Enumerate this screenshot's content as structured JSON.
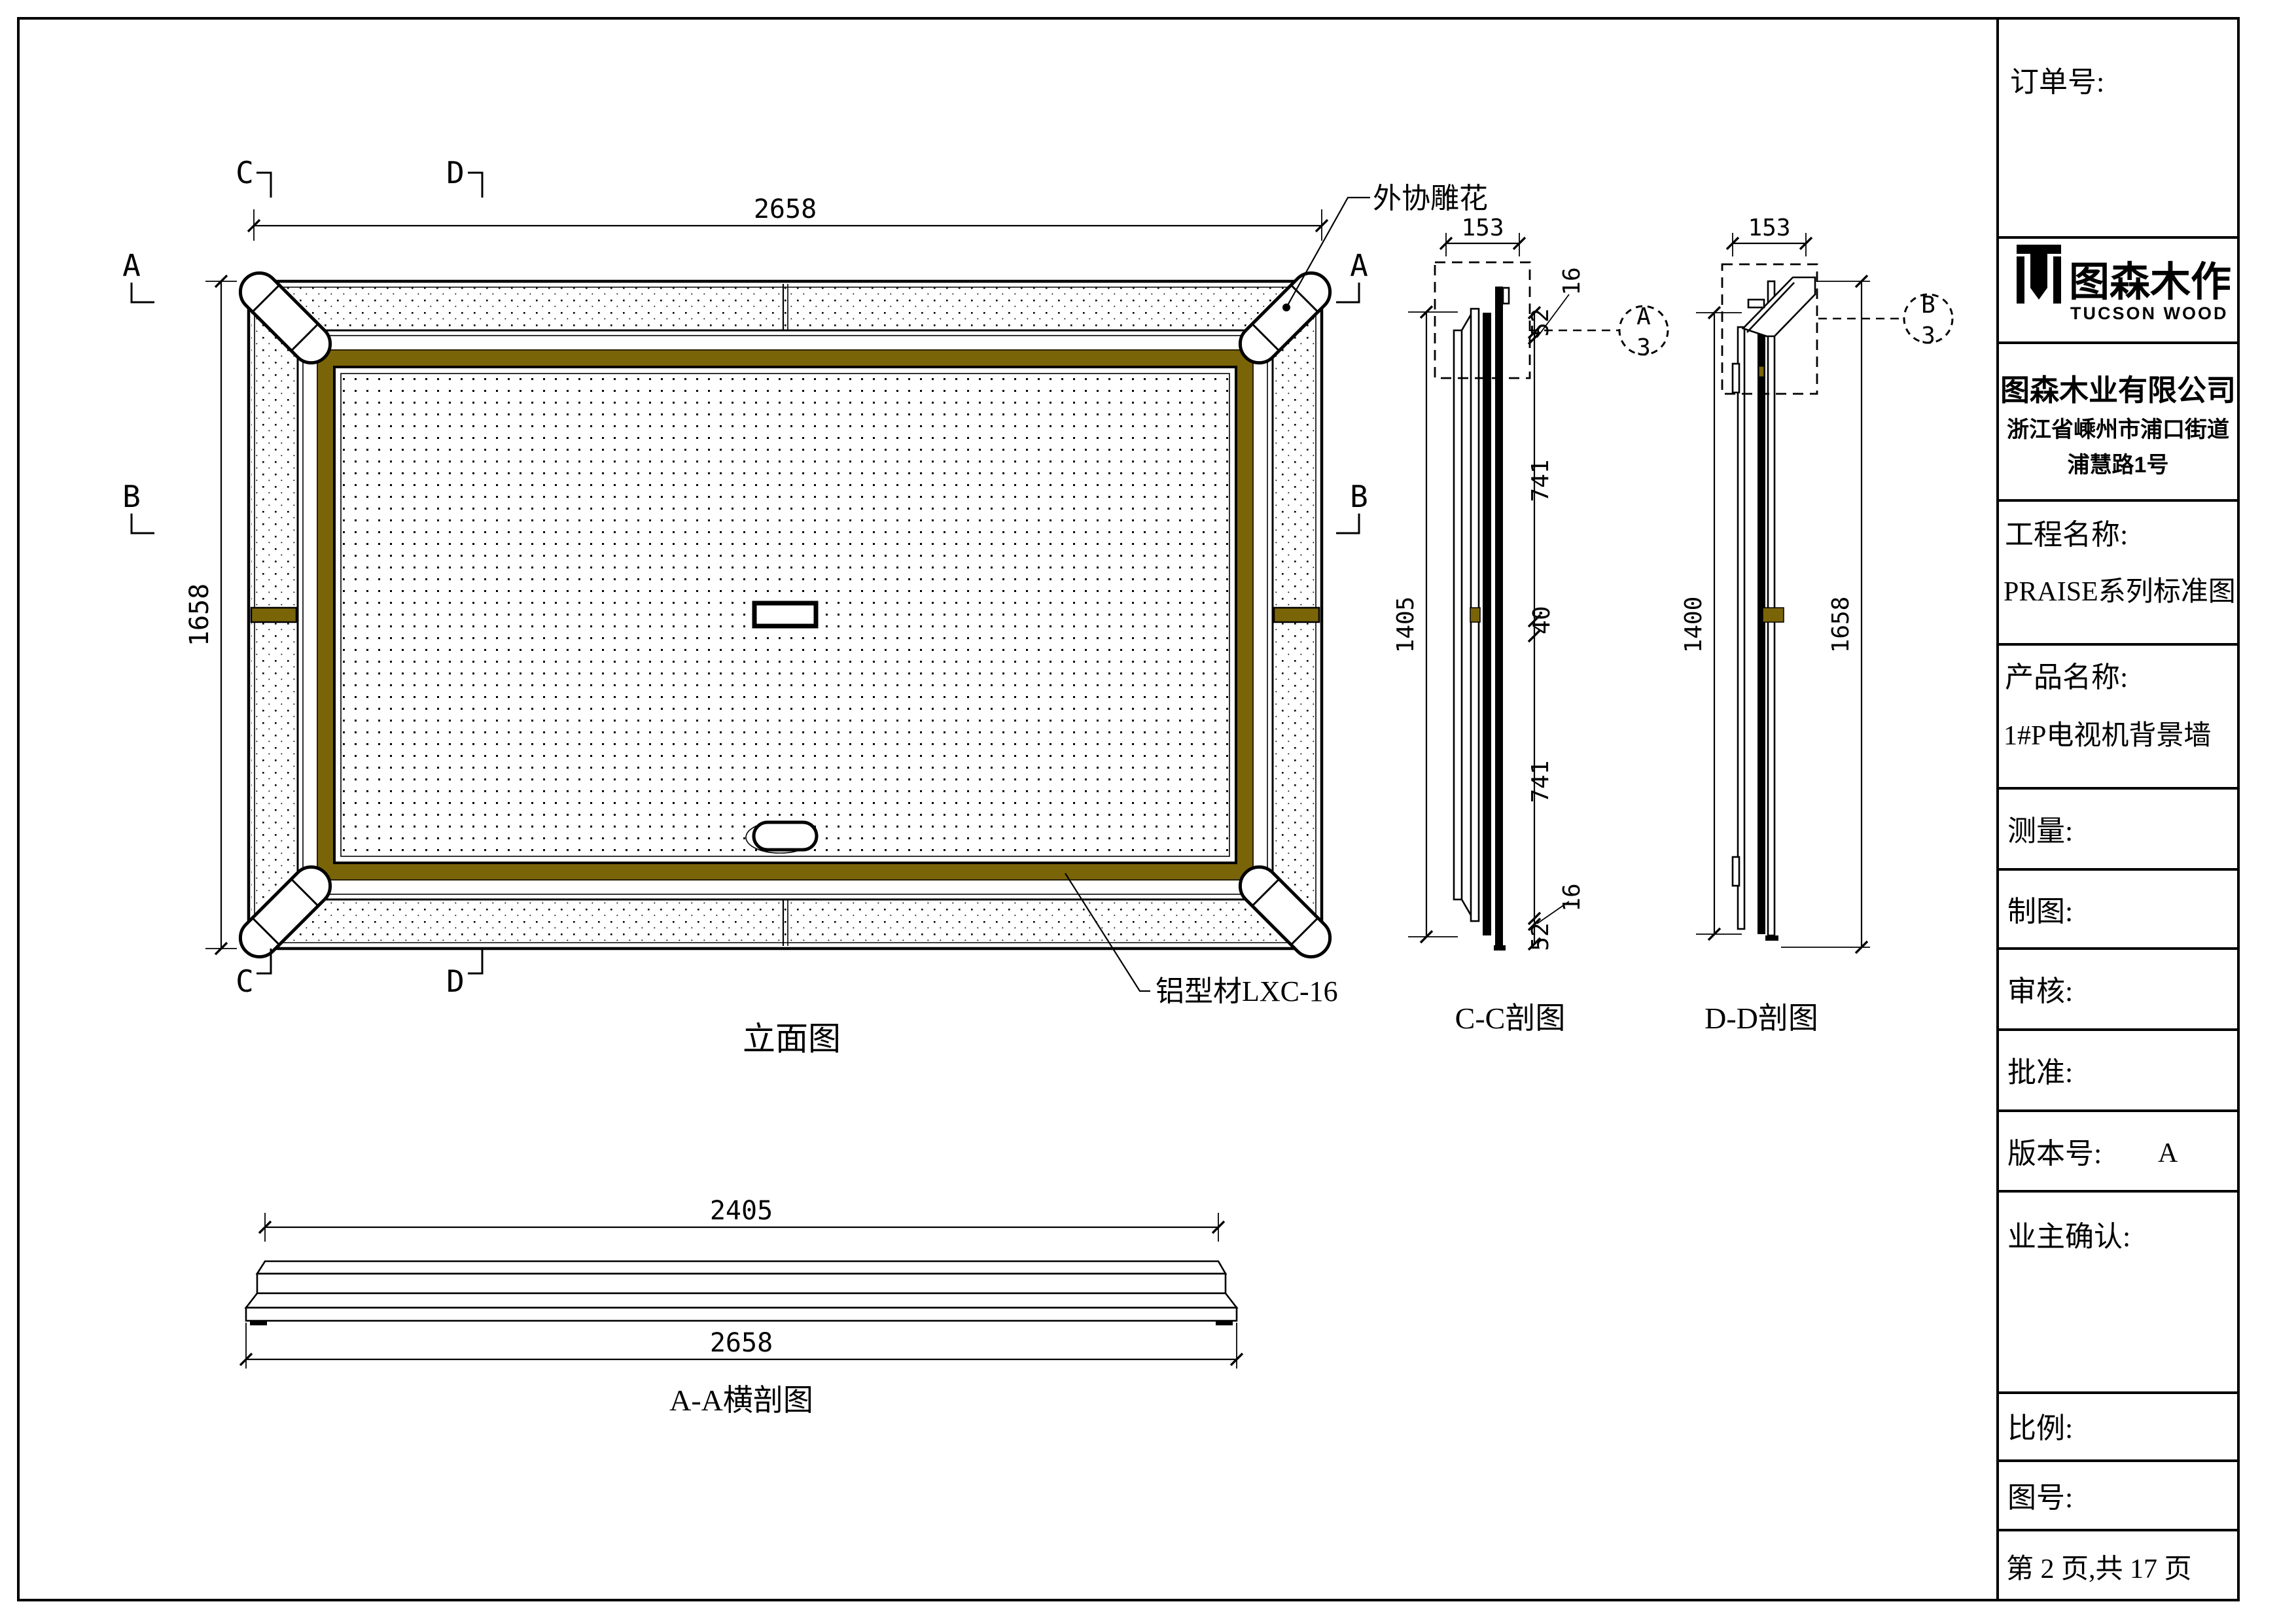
{
  "title_block": {
    "order_label": "订单号:",
    "logo": {
      "cn": "图森木作",
      "en": "TUCSON WOOD"
    },
    "company": "图森木业有限公司",
    "address_line1": "浙江省嵊州市浦口街道",
    "address_line2": "浦慧路1号",
    "project_label": "工程名称:",
    "project_value": "PRAISE系列标准图",
    "product_label": "产品名称:",
    "product_value": "1#P电视机背景墙",
    "survey_label": "测量:",
    "draft_label": "制图:",
    "review_label": "审核:",
    "approve_label": "批准:",
    "version_label": "版本号:",
    "version_value": "A",
    "owner_label": "业主确认:",
    "scale_label": "比例:",
    "drawing_no_label": "图号:",
    "page_label": "第 2 页,共 17 页"
  },
  "views": {
    "elevation_label": "立面图",
    "cc_label": "C-C剖图",
    "dd_label": "D-D剖图",
    "aa_label": "A-A横剖图"
  },
  "annotations": {
    "carving": "外协雕花",
    "profile": "铝型材LXC-16"
  },
  "markers": {
    "a": "A",
    "b": "B",
    "c": "C",
    "d": "D",
    "detail_a": "A",
    "detail_b": "B",
    "detail_sheet": "3"
  },
  "dims": {
    "elev_width": "2658",
    "elev_height": "1658",
    "cc_width": "153",
    "cc_height": "1405",
    "cc_52_top": "52",
    "cc_16_top": "16",
    "cc_741_upper": "741",
    "cc_40_mid": "40",
    "cc_741_lower": "741",
    "cc_16_bottom": "16",
    "cc_52_bottom": "52",
    "dd_width": "153",
    "dd_height_left": "1400",
    "dd_height_right": "1658",
    "aa_inner_width": "2405",
    "aa_outer_width": "2658"
  },
  "colors": {
    "gold": "#7a6408",
    "line": "#000000",
    "paper": "#ffffff"
  }
}
